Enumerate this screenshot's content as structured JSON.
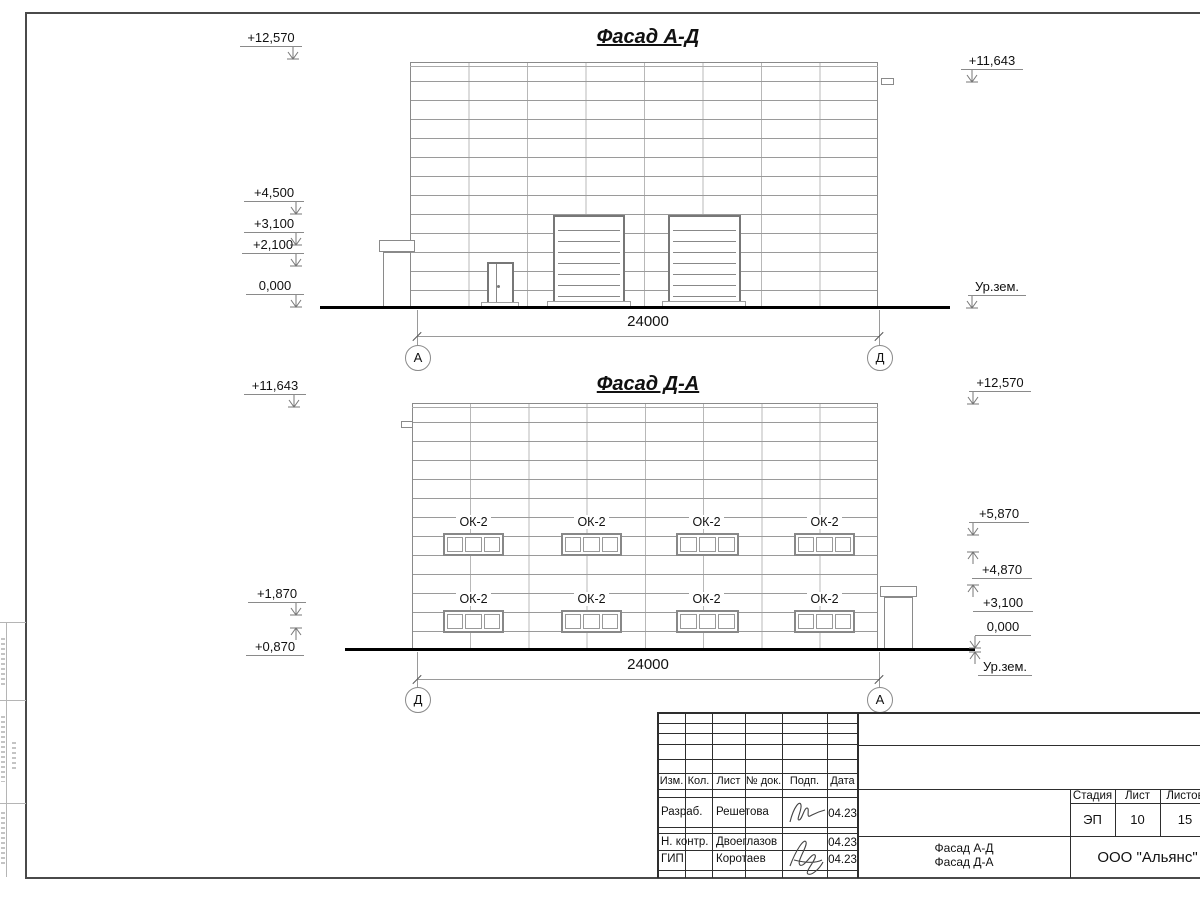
{
  "sheet": {
    "facade_ad": {
      "title": "Фасад А-Д",
      "marks_left": [
        "+12,570",
        "+4,500",
        "+3,100",
        "+2,100",
        "0,000"
      ],
      "marks_right": [
        "+11,643",
        "Ур.зем."
      ],
      "dimension": "24000",
      "axis_left": "А",
      "axis_right": "Д"
    },
    "facade_da": {
      "title": "Фасад Д-А",
      "marks_left": [
        "+11,643",
        "+1,870",
        "+0,870"
      ],
      "marks_right": [
        "+12,570",
        "+5,870",
        "+4,870",
        "+3,100",
        "0,000",
        "Ур.зем."
      ],
      "dimension": "24000",
      "axis_left": "Д",
      "axis_right": "А",
      "window_label": "ОК-2"
    },
    "titleblock": {
      "rev_headers": [
        "Изм.",
        "Кол.",
        "Лист",
        "№ док.",
        "Подп.",
        "Дата"
      ],
      "roles": [
        {
          "role": "Разраб.",
          "name": "Решетова",
          "date": "04.23"
        },
        {
          "role": "Н. контр.",
          "name": "Двоеглазов",
          "date": "04.23"
        },
        {
          "role": "ГИП",
          "name": "Коротаев",
          "date": "04.23"
        }
      ],
      "stage_label": "Стадия",
      "sheet_label": "Лист",
      "sheets_label": "Листов",
      "stage": "ЭП",
      "sheet_no": "10",
      "sheets_total": "15",
      "doc_name": [
        "Фасад А-Д",
        "Фасад Д-А"
      ],
      "company": "ООО \"Альянс\""
    }
  }
}
